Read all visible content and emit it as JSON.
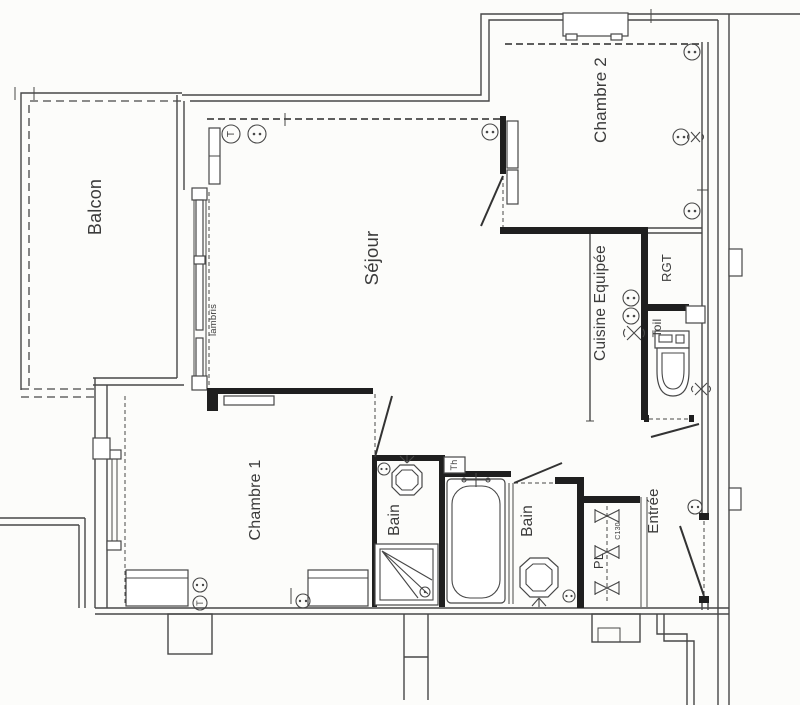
{
  "plan": {
    "type": "apartment-floor-plan",
    "rooms": {
      "balcon": {
        "label": "Balcon"
      },
      "sejour": {
        "label": "Séjour"
      },
      "chambre2": {
        "label": "Chambre 2"
      },
      "chambre1": {
        "label": "Chambre 1"
      },
      "cuisine": {
        "label": "Cuisine Equipée"
      },
      "rgt": {
        "label": "RGT"
      },
      "toil": {
        "label": "Toil"
      },
      "bain1": {
        "label": "Bain"
      },
      "bain2": {
        "label": "Bain"
      },
      "entree": {
        "label": "Entrée"
      }
    },
    "annotations": {
      "lambris": "lambris",
      "thermostat_box": "Th",
      "switch": "T",
      "closet": "PL",
      "closet_dim": "C130"
    },
    "colors": {
      "wall": "#1f1f1f",
      "line": "#474747",
      "text": "#3b3b3b",
      "background": "#fcfcfa"
    }
  }
}
